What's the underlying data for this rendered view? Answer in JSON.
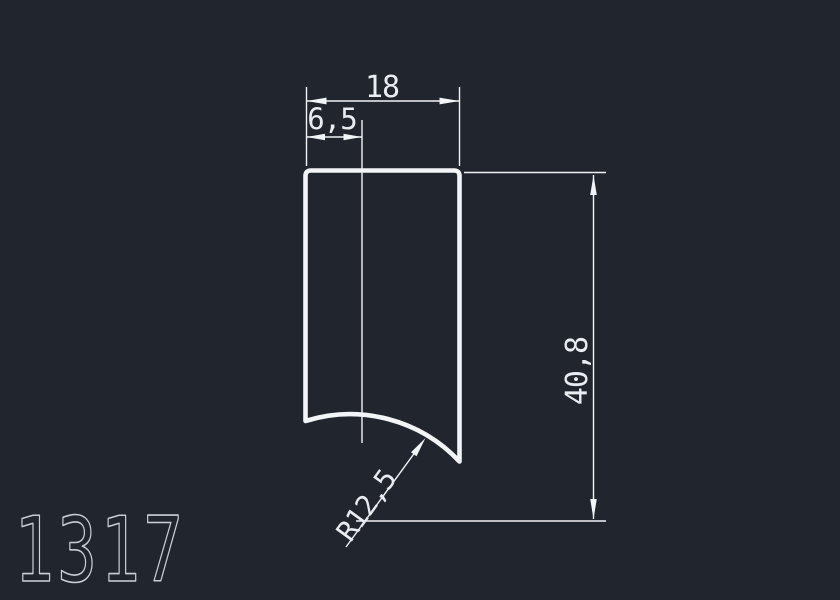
{
  "drawing": {
    "part_label": "1317",
    "dimensions": {
      "width": "18",
      "offset": "6,5",
      "height": "40,8",
      "radius": "R12,5"
    },
    "colors": {
      "background": "#20252e",
      "line": "#f2f4f7",
      "dim_text": "#e9edf2",
      "part_label_color": "#c9cfd8"
    }
  }
}
